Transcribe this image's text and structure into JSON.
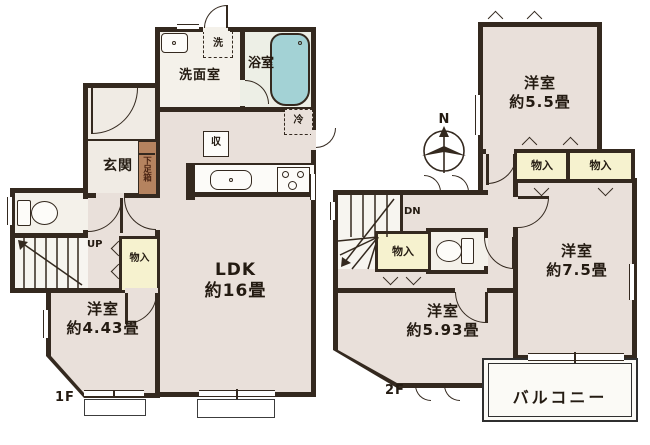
{
  "plan_type": "floor-plan",
  "colors": {
    "wall": "#34291f",
    "room_floor": "#e9e0da",
    "wet_area_floor": "#f4f1ea",
    "closet_fill": "#f6f2cf",
    "bathtub_fill": "#a3d2d5",
    "shoe_cabinet_fill": "#b5835f"
  },
  "f1": {
    "floor": "1F",
    "washroom": "洗面室",
    "bath": "浴室",
    "washer": "洗",
    "fridge": "冷",
    "pantry": "収",
    "genkan": "玄関",
    "shoe": "下足箱",
    "closet": "物入",
    "up": "UP",
    "ldk": "LDK",
    "ldk_size": "約16畳",
    "bed": "洋室",
    "bed_size": "約4.43畳"
  },
  "f2": {
    "floor": "2F",
    "north": "N",
    "dn": "DN",
    "closet_hall": "物入",
    "closet_a": "物入",
    "closet_b": "物入",
    "bed55": "洋室",
    "bed55_size": "約5.5畳",
    "bed75": "洋室",
    "bed75_size": "約7.5畳",
    "bed593": "洋室",
    "bed593_size": "約5.93畳",
    "balcony": "バルコニー"
  }
}
